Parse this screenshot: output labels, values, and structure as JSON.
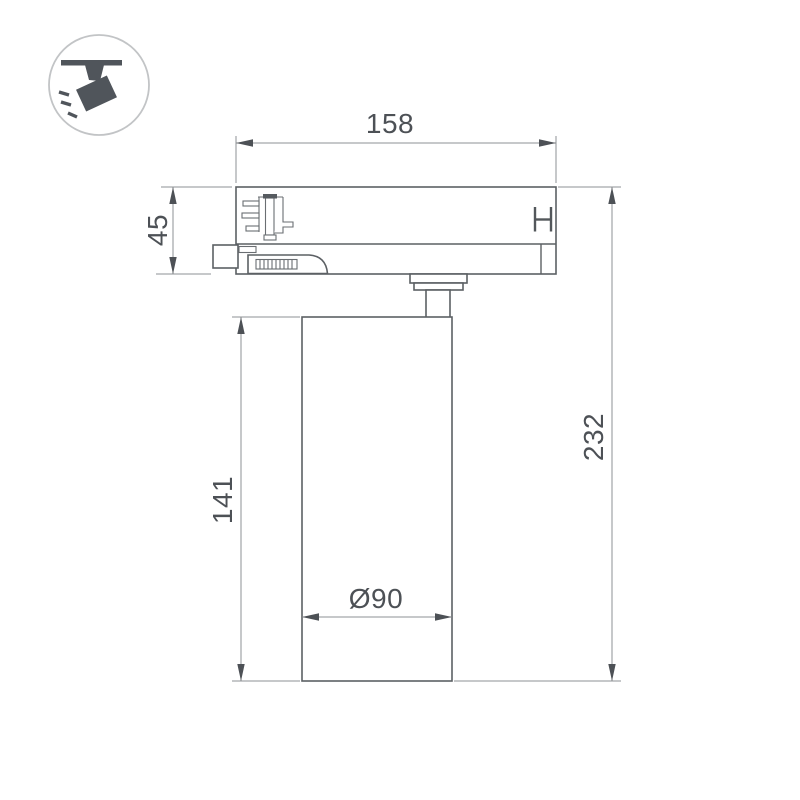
{
  "page": {
    "type": "technical-dimension-drawing",
    "subject": "track-mounted cylindrical spotlight, side view",
    "background_color": "#ffffff"
  },
  "icon": {
    "name": "track-spotlight-pictogram",
    "description": "ceiling track with tilted spotlight head and light rays",
    "glyph_color": "#50555b",
    "circle_stroke_color": "#c2c4c6"
  },
  "drawing": {
    "outline_color": "#5c6064",
    "dimension_line_color": "#8e9194",
    "arrow_color": "#4d5156",
    "text_color": "#4d5156"
  },
  "dimensions": {
    "top_width": "158",
    "adapter_height": "45",
    "body_height": "141",
    "total_height": "232",
    "body_diameter": "Ø90"
  }
}
